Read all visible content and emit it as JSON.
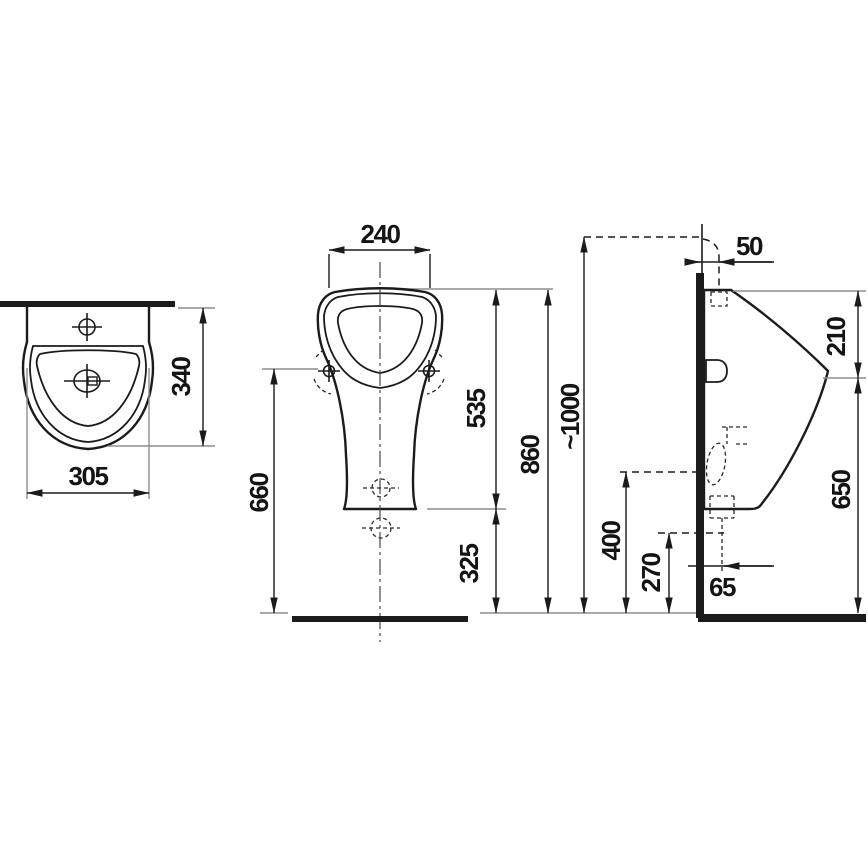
{
  "dimensions": {
    "plan_width": "305",
    "plan_depth": "340",
    "rim_width": "240",
    "mounting_holes_height": "660",
    "rim_to_base": "535",
    "base_to_floor": "325",
    "overall_height": "860",
    "inlet_level": "~1000",
    "inlet_wall_offset": "50",
    "top_to_front_edge": "210",
    "front_edge_height": "650",
    "trap_level": "400",
    "outlet_level": "270",
    "outlet_wall_offset": "65"
  }
}
